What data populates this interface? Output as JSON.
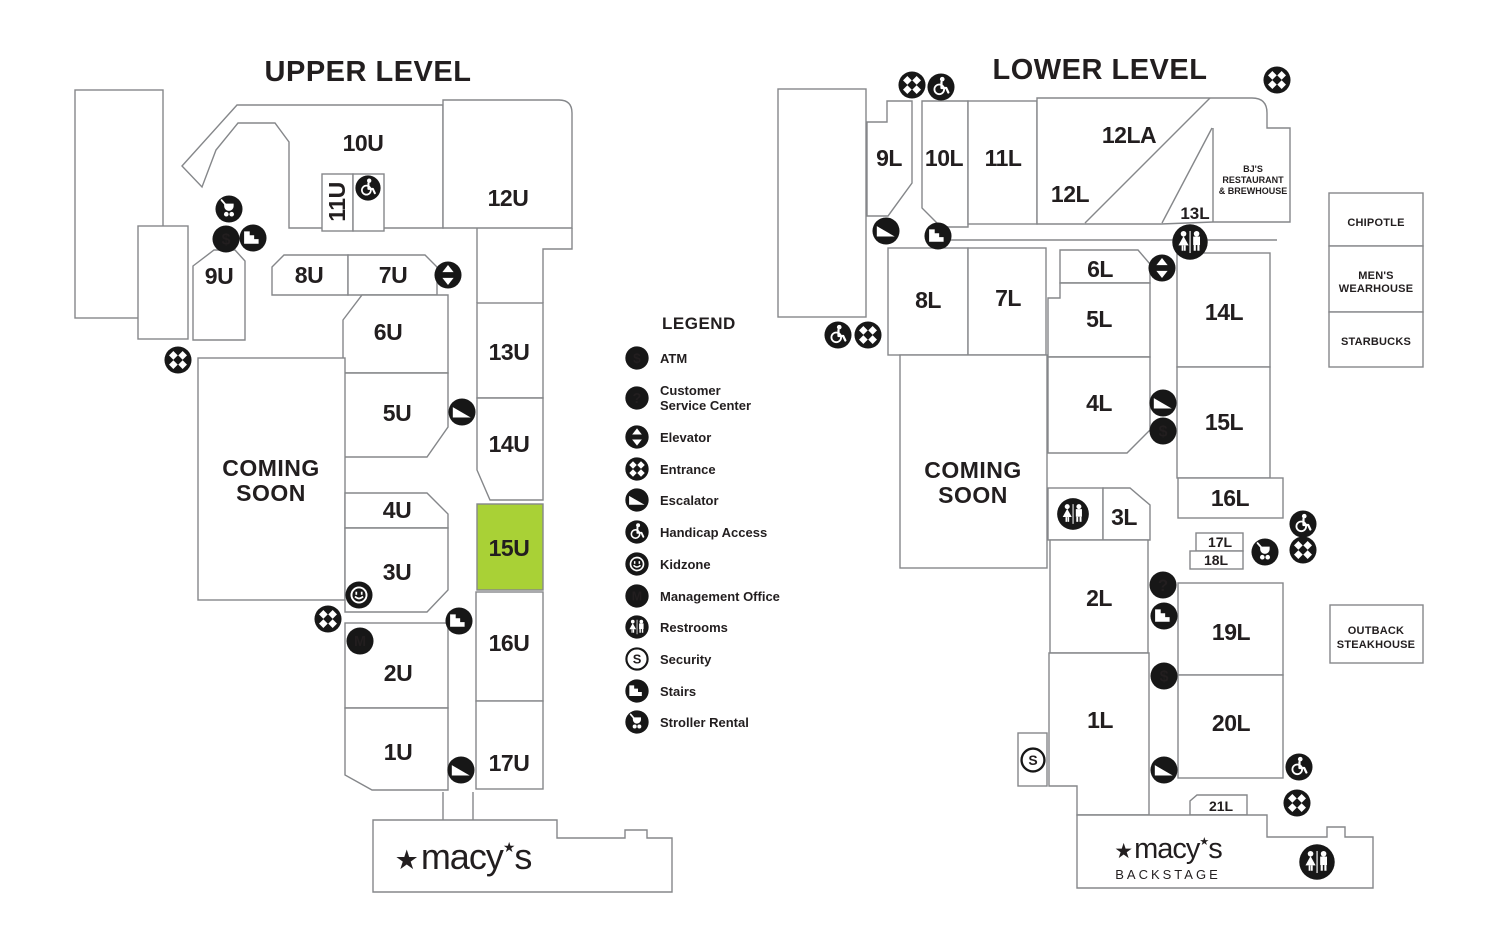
{
  "colors": {
    "highlight": "#A9D136",
    "line": "#85878A",
    "icon": "#171717",
    "text": "#221E1F",
    "background": "#FFFFFF"
  },
  "icon_glyphs": {
    "atm": "$",
    "customer_service": "?",
    "management": "M",
    "security": "S"
  },
  "upper": {
    "title": "UPPER LEVEL",
    "coming_soon": [
      "COMING",
      "SOON"
    ],
    "highlighted_unit": "15U",
    "units": {
      "u1": "1U",
      "u2": "2U",
      "u3": "3U",
      "u4": "4U",
      "u5": "5U",
      "u6": "6U",
      "u7": "7U",
      "u8": "8U",
      "u9": "9U",
      "u10": "10U",
      "u11": "11U",
      "u12": "12U",
      "u13": "13U",
      "u14": "14U",
      "u15": "15U",
      "u16": "16U",
      "u17": "17U"
    },
    "macys": {
      "star": "★",
      "word": "macy",
      "apostrophe_star": "★",
      "letter": "s"
    }
  },
  "lower": {
    "title": "LOWER LEVEL",
    "coming_soon": [
      "COMING",
      "SOON"
    ],
    "units": {
      "l1": "1L",
      "l2": "2L",
      "l3": "3L",
      "l4": "4L",
      "l5": "5L",
      "l6": "6L",
      "l7": "7L",
      "l8": "8L",
      "l9": "9L",
      "l10": "10L",
      "l11": "11L",
      "l12": "12L",
      "l12a": "12LA",
      "l13": "13L",
      "l14": "14L",
      "l15": "15L",
      "l16": "16L",
      "l17": "17L",
      "l18": "18L",
      "l19": "19L",
      "l20": "20L",
      "l21": "21L"
    },
    "macys_backstage": {
      "star": "★",
      "word": "macy",
      "apostrophe_star": "★",
      "letter": "s",
      "sub": "BACKSTAGE"
    },
    "tenants": {
      "bjs": [
        "BJ'S",
        "RESTAURANT",
        "& BREWHOUSE"
      ],
      "chipotle": "CHIPOTLE",
      "mens_wearhouse": [
        "MEN'S",
        "WEARHOUSE"
      ],
      "starbucks": "STARBUCKS",
      "outback": [
        "OUTBACK",
        "STEAKHOUSE"
      ]
    }
  },
  "legend": {
    "title": "LEGEND",
    "items": [
      {
        "icon": "atm-icon",
        "label": "ATM"
      },
      {
        "icon": "customer-service-icon",
        "lines": [
          "Customer",
          "Service Center"
        ]
      },
      {
        "icon": "elevator-icon",
        "label": "Elevator"
      },
      {
        "icon": "entrance-icon",
        "label": "Entrance"
      },
      {
        "icon": "escalator-icon",
        "label": "Escalator"
      },
      {
        "icon": "handicap-icon",
        "label": "Handicap Access"
      },
      {
        "icon": "kidzone-icon",
        "label": "Kidzone"
      },
      {
        "icon": "management-icon",
        "label": "Management Office"
      },
      {
        "icon": "restrooms-icon",
        "label": "Restrooms"
      },
      {
        "icon": "security-icon",
        "label": "Security"
      },
      {
        "icon": "stairs-icon",
        "label": "Stairs"
      },
      {
        "icon": "stroller-icon",
        "label": "Stroller Rental"
      }
    ]
  }
}
